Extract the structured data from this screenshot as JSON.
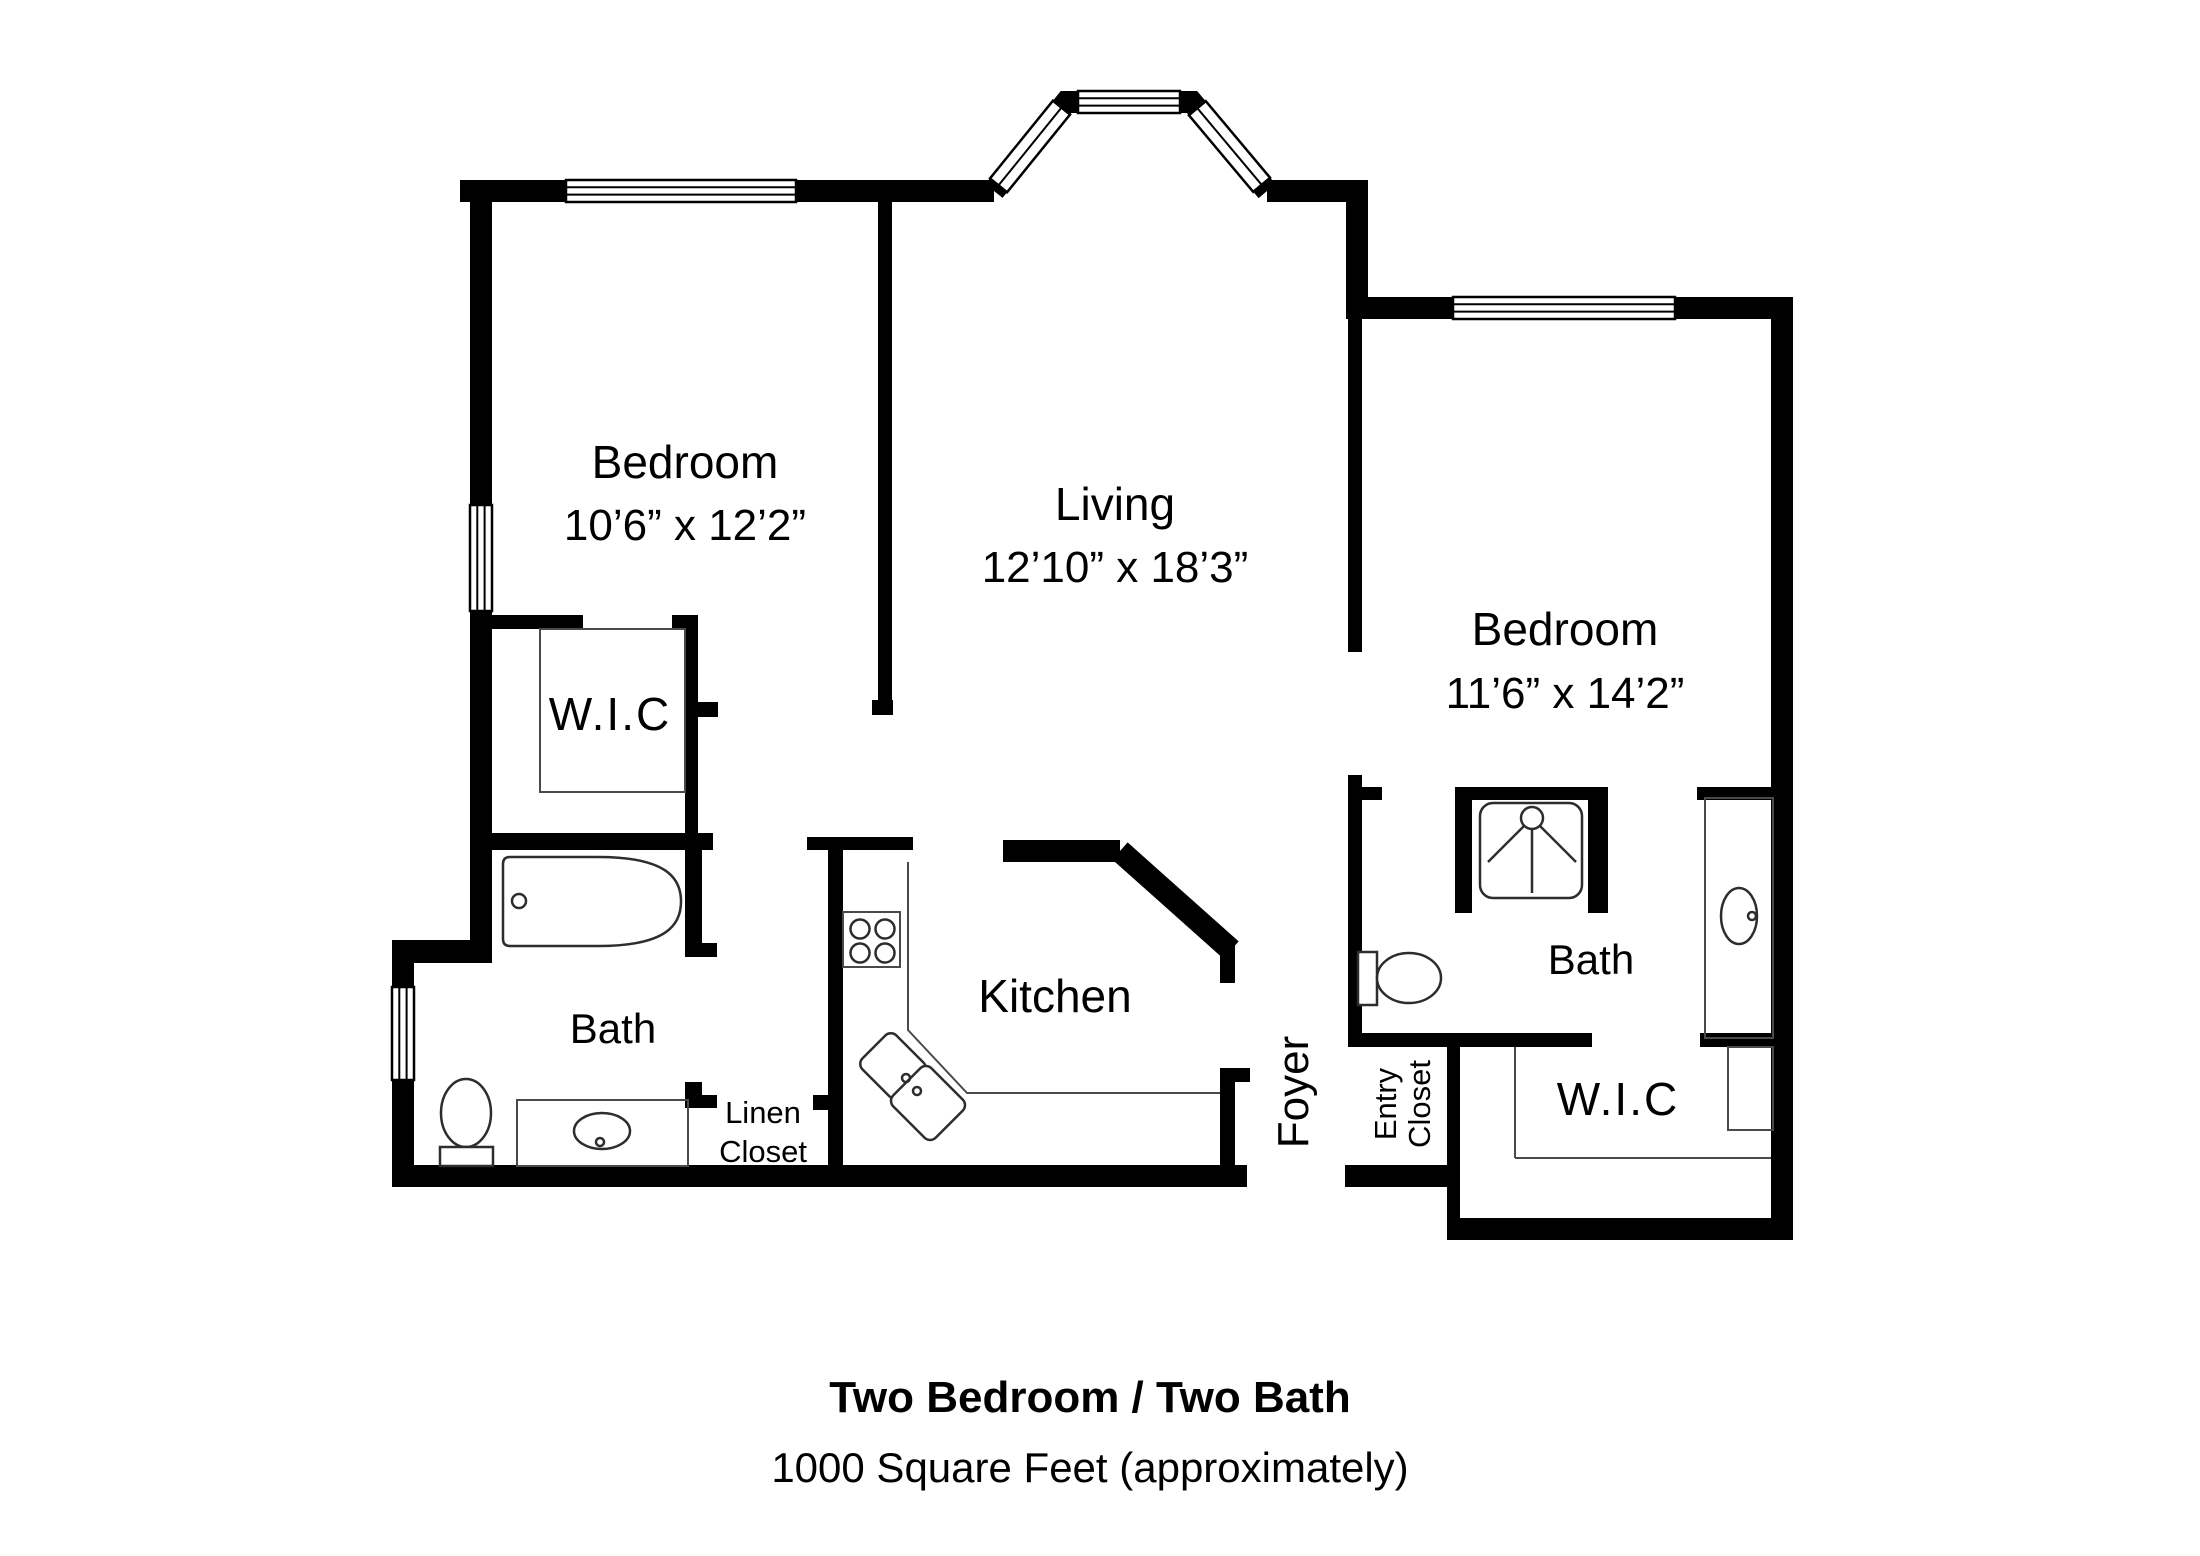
{
  "plan": {
    "rooms": [
      {
        "name": "bedroom-left",
        "label": "Bedroom",
        "dims": "10’6” x 12’2”"
      },
      {
        "name": "living",
        "label": "Living",
        "dims": "12’10” x 18’3”"
      },
      {
        "name": "bedroom-right",
        "label": "Bedroom",
        "dims": "11’6” x 14’2”"
      },
      {
        "name": "wic-left",
        "label": "W.I.C"
      },
      {
        "name": "bath-left",
        "label": "Bath"
      },
      {
        "name": "kitchen",
        "label": "Kitchen"
      },
      {
        "name": "linen-closet",
        "line1": "Linen",
        "line2": "Closet"
      },
      {
        "name": "foyer",
        "label": "Foyer"
      },
      {
        "name": "entry-closet",
        "line1": "Entry",
        "line2": "Closet"
      },
      {
        "name": "bath-right",
        "label": "Bath"
      },
      {
        "name": "wic-right",
        "label": "W.I.C"
      }
    ],
    "fixtures": [
      "bathtub",
      "toilet",
      "vanity-sink",
      "closet-rod",
      "stove",
      "kitchen-double-sink",
      "shower",
      "toilet",
      "vanity-sink",
      "closet-rod"
    ],
    "colors": {
      "wall": "#000000",
      "background": "#ffffff",
      "fixture_outline": "#2d2d2d"
    }
  },
  "caption": {
    "title": "Two Bedroom / Two Bath",
    "subtitle": "1000 Square Feet (approximately)"
  }
}
